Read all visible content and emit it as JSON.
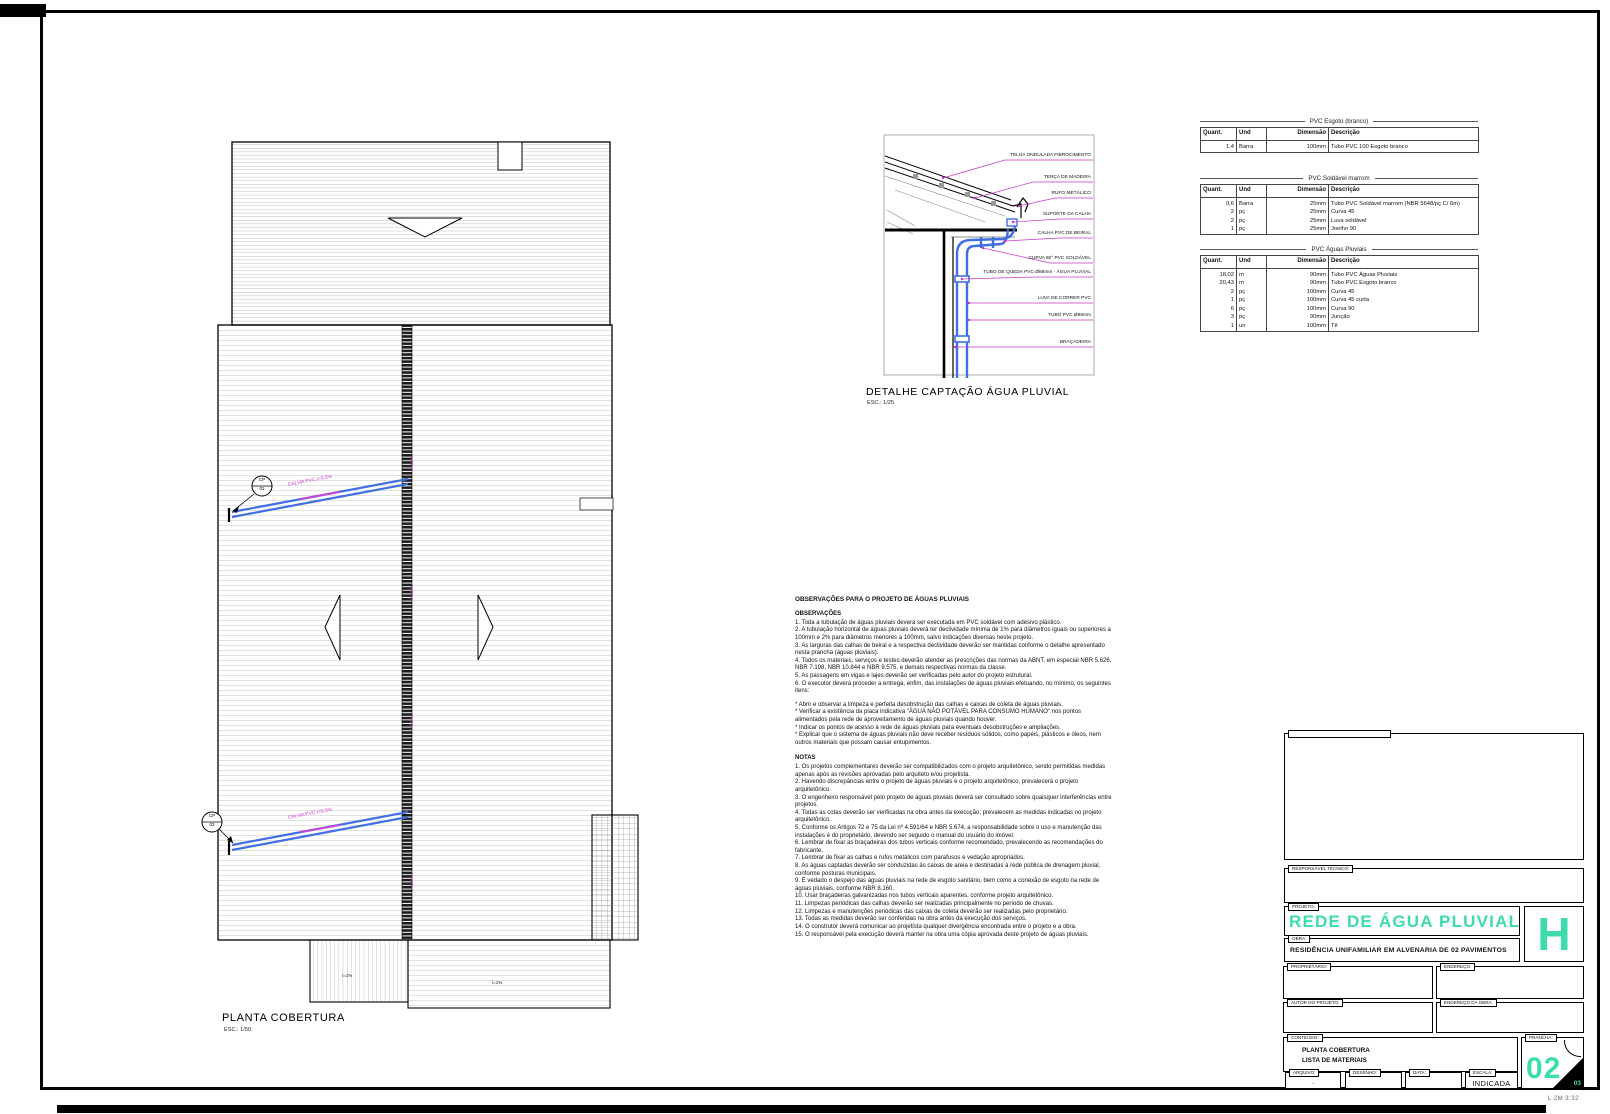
{
  "sheet": {
    "plot_stamp": "L 2M 3:32"
  },
  "plan": {
    "title": "PLANTA COBERTURA",
    "scale": "ESC.: 1/50",
    "gutters": [
      {
        "label": "CALHA PVC  i=0,5%"
      },
      {
        "label": "CALHA PVC  i=0,5%"
      }
    ],
    "drains": [
      {
        "tag": "CP",
        "num": "01"
      },
      {
        "tag": "CP",
        "num": "02"
      }
    ],
    "slope_marks": [
      "i=0,5%",
      "i=0,5%",
      "i=0,5%",
      "i=0,5%"
    ],
    "misc_marks": [
      "i=1%",
      "i=1%"
    ]
  },
  "detail": {
    "title": "DETALHE CAPTAÇÃO ÁGUA PLUVIAL",
    "scale": "ESC.: 1/25",
    "labels": [
      "TELHA ONDULADA FIBROCIMENTO",
      "TERÇA DE MADEIRA",
      "RUFO METÁLICO",
      "SUPORTE DA CALHA",
      "CALHA PVC DE BEIRAL",
      "CURVA 90° PVC SOLDÁVEL",
      "TUBO DE QUEDA PVC Ø88mm - ÁGUA PLUVIAL",
      "LUVA DE CORRER PVC",
      "TUBO PVC Ø88mm",
      "BRAÇADEIRA"
    ]
  },
  "tables": [
    {
      "title": "PVC Esgoto (branco)",
      "headers": [
        "Quant.",
        "Und",
        "Dimensão",
        "Descrição"
      ],
      "rows": [
        [
          "1,4",
          "Barra",
          "100mm",
          "Tubo PVC 100 Esgoto branco"
        ]
      ]
    },
    {
      "title": "PVC Soldável marrom",
      "headers": [
        "Quant.",
        "Und",
        "Dimensão",
        "Descrição"
      ],
      "rows": [
        [
          "0,6",
          "Barra",
          "25mm",
          "Tubo PVC Soldável marrom (NBR 5648/pç C/ 6m)"
        ],
        [
          "2",
          "pç",
          "25mm",
          "Curva 45"
        ],
        [
          "2",
          "pç",
          "25mm",
          "Luva soldável"
        ],
        [
          "1",
          "pç",
          "25mm",
          "Joelho 90"
        ]
      ]
    },
    {
      "title": "PVC Águas Pluviais",
      "headers": [
        "Quant.",
        "Und",
        "Dimensão",
        "Descrição"
      ],
      "rows": [
        [
          "18,02",
          "m",
          "90mm",
          "Tubo PVC Águas Pluviais"
        ],
        [
          "20,43",
          "m",
          "90mm",
          "Tubo PVC Esgoto branco"
        ],
        [
          "2",
          "pç",
          "100mm",
          "Curva 45"
        ],
        [
          "1",
          "pç",
          "100mm",
          "Curva 45 curta"
        ],
        [
          "6",
          "pç",
          "100mm",
          "Curva 90"
        ],
        [
          "3",
          "pç",
          "90mm",
          "Junção"
        ],
        [
          "1",
          "un",
          "100mm",
          "Tê"
        ]
      ]
    }
  ],
  "notes": {
    "title": "OBSERVAÇÕES PARA O PROJETO DE ÁGUAS PLUVIAIS",
    "obs_heading": "OBSERVAÇÕES",
    "obs_body": "1. Toda a tubulação de águas pluviais deverá ser executada em PVC soldável com adesivo plástico.\n2. A tubulação horizontal de águas pluviais deverá ter declividade mínima de 1% para diâmetros iguais ou superiores a 100mm e 2% para diâmetros menores a 100mm, salvo indicações diversas neste projeto.\n3. As larguras das calhas de beiral e a respectiva declividade deverão ser mantidas conforme o detalhe apresentado nesta prancha (águas pluviais).\n4. Todos os materiais, serviços e testes deverão atender as prescrições das normas da ABNT, em especial NBR 5.626, NBR 7.198, NBR 10.844 e NBR 9.575, e demais respectivas normas da classe.\n5. As passagens em vigas e lajes deverão ser verificadas pelo autor do projeto estrutural.\n6. O executor deverá proceder a entrega, enfim, das instalações de águas pluviais efetuando, no mínimo, os seguintes itens:",
    "stars_body": "* Abrir e observar a limpeza e perfeita desobstrução das calhas e caixas de coleta de águas pluviais.\n* Verificar a existência da placa indicativa \"ÁGUA NÃO POTÁVEL PARA CONSUMO HUMANO\" nos pontos alimentados pela rede de aproveitamento de águas pluviais quando houver.\n* Indicar os pontos de acesso à rede de águas pluviais para eventuais desobstruções e ampliações.\n* Explicar que o sistema de águas pluviais não deve receber resíduos sólidos, como papéis, plásticos e óleos, nem outros materiais que possam causar entupimentos.",
    "notas_heading": "NOTAS",
    "notas_body": "1. Os projetos complementares deverão ser compatibilizados com o projeto arquitetônico, sendo permitidas medidas apenas após as revisões aprovadas pelo arquiteto e/ou projetista.\n2. Havendo discrepâncias entre o projeto de águas pluviais e o projeto arquitetônico, prevalecerá o projeto arquitetônico.\n3. O engenheiro responsável pelo projeto de águas pluviais deverá ser consultado sobre quaisquer interferências entre projetos.\n4. Todas as cotas deverão ser verificadas na obra antes da execução; prevalecem as medidas indicadas no projeto arquitetônico.\n5. Conforme os Artigos 72 e 75 da Lei nº 4.591/64 e NBR 5.674, a responsabilidade sobre o uso e manutenção das instalações é do proprietário, devendo ser seguido o manual do usuário do imóvel.\n6. Lembrar de fixar as braçadeiras dos tubos verticais conforme recomendado, prevalecendo as recomendações do fabricante.\n7. Lembrar de fixar as calhas e rufos metálicos com parafusos e vedação apropriados.\n8. As águas captadas deverão ser conduzidas às caixas de areia e destinadas à rede pública de drenagem pluvial, conforme posturas municipais.\n9. É vedado o despejo das águas pluviais na rede de esgoto sanitário, bem como a conexão de esgoto na rede de águas pluviais, conforme NBR 8.160.\n10. Usar braçadeiras galvanizadas nos tubos verticais aparentes, conforme projeto arquitetônico.\n11. Limpezas periódicas das calhas deverão ser realizadas principalmente no período de chuvas.\n12. Limpezas e manutenções periódicas das caixas de coleta deverão ser realizadas pelo proprietário.\n13. Todas as medidas deverão ser conferidas na obra antes da execução dos serviços.\n14. O construtor deverá comunicar ao projetista qualquer divergência encontrada entre o projeto e a obra.\n15. O responsável pela execução deverá manter na obra uma cópia aprovada deste projeto de águas pluviais."
  },
  "titleblock": {
    "resp_tab": "RESPONSÁVEL TÉCNICO:",
    "project_tab": "PROJETO:",
    "project_title": "REDE DE ÁGUA PLUVIAL",
    "obra_tab": "OBRA:",
    "obra_title": "RESIDÊNCIA UNIFAMILIAR EM ALVENARIA DE 02 PAVIMENTOS",
    "big_letter": "H",
    "owner_tab": "PROPRIETÁRIO:",
    "address_tab": "ENDEREÇO:",
    "author_tab": "AUTOR DO PROJETO:",
    "site_tab": "ENDEREÇO DA OBRA:",
    "content_tab": "CONTEÚDO:",
    "content_line1": "PLANTA COBERTURA",
    "content_line2": "LISTA DE MATERIAIS",
    "sheet_tab": "PRANCHA:",
    "sheet_number": "02",
    "sheet_total": "03",
    "file_tab": "ARQUIVO:",
    "file_value": ".",
    "drawing_tab": "DESENHO:",
    "date_tab": "DATA:",
    "scale_tab": "ESCALA:",
    "scale_value": "INDICADA"
  }
}
